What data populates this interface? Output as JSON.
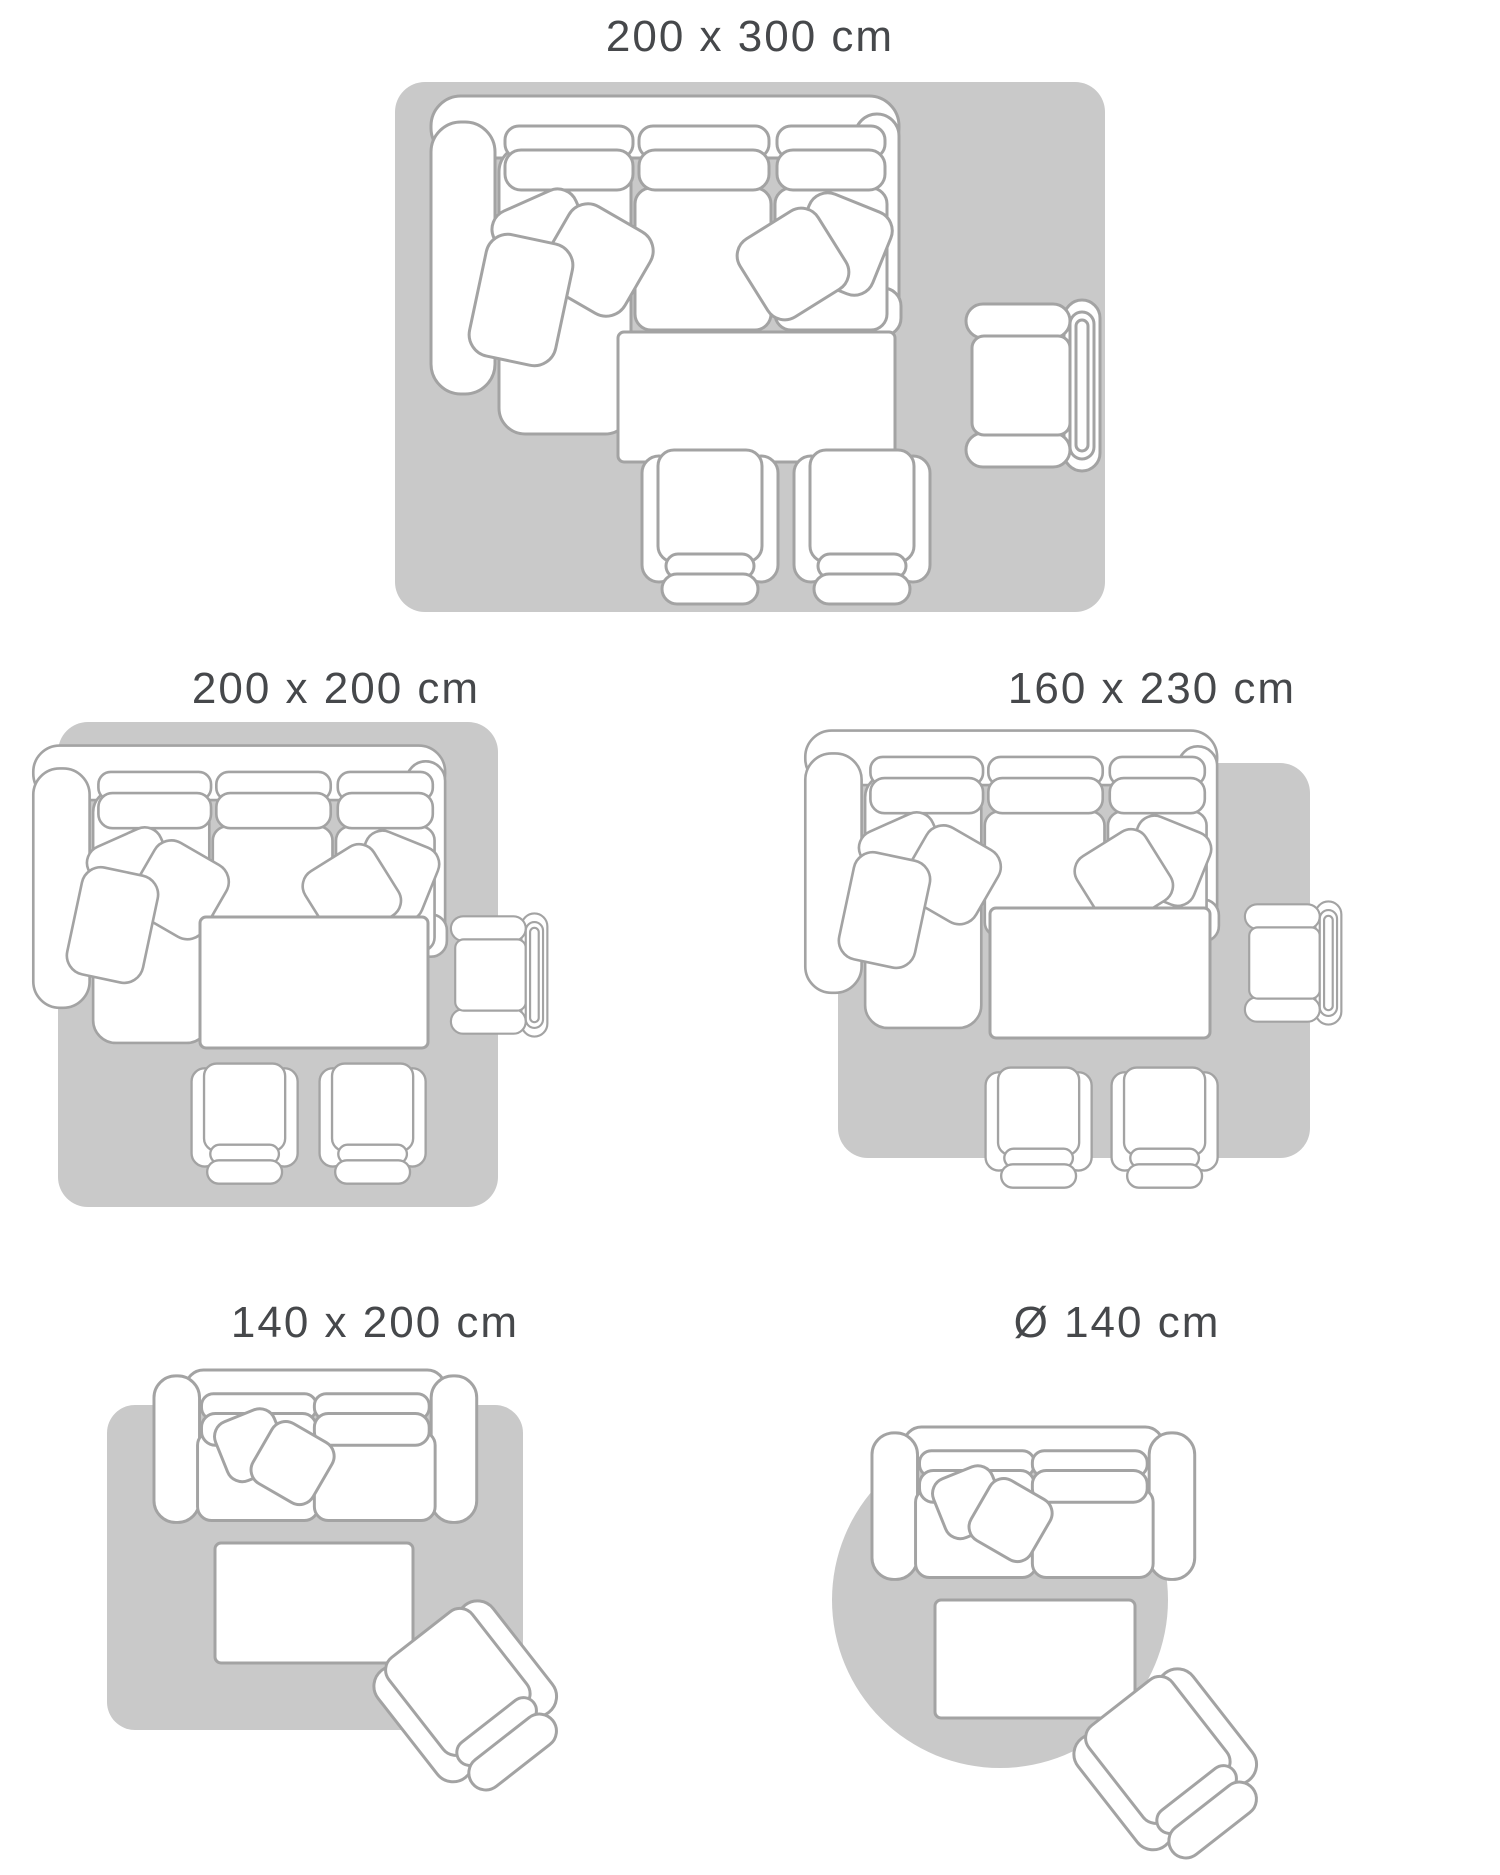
{
  "page": {
    "type": "rug-size-guide",
    "background": "#ffffff"
  },
  "colors": {
    "rug_fill": "#c9c9c9",
    "furniture_outline": "#a3a3a3",
    "furniture_fill": "#ffffff",
    "title_text": "#46484b"
  },
  "layouts": [
    {
      "id": "200x300",
      "label": "200 x 300 cm",
      "rug_shape": "rectangle",
      "furniture": [
        "corner-sofa-with-chaise",
        "coffee-table",
        "armchair",
        "small-armchair",
        "small-armchair"
      ]
    },
    {
      "id": "200x200",
      "label": "200 x 200 cm",
      "rug_shape": "square",
      "furniture": [
        "corner-sofa-with-chaise",
        "coffee-table",
        "armchair",
        "small-armchair",
        "small-armchair"
      ]
    },
    {
      "id": "160x230",
      "label": "160 x 230 cm",
      "rug_shape": "rectangle",
      "furniture": [
        "corner-sofa-with-chaise",
        "coffee-table",
        "armchair",
        "small-armchair",
        "small-armchair"
      ]
    },
    {
      "id": "140x200",
      "label": "140 x 200 cm",
      "rug_shape": "rectangle",
      "furniture": [
        "two-seat-sofa",
        "coffee-table",
        "tilted-armchair"
      ]
    },
    {
      "id": "d140",
      "label": "Ø 140 cm",
      "rug_shape": "circle",
      "furniture": [
        "two-seat-sofa",
        "coffee-table",
        "tilted-armchair"
      ]
    }
  ]
}
